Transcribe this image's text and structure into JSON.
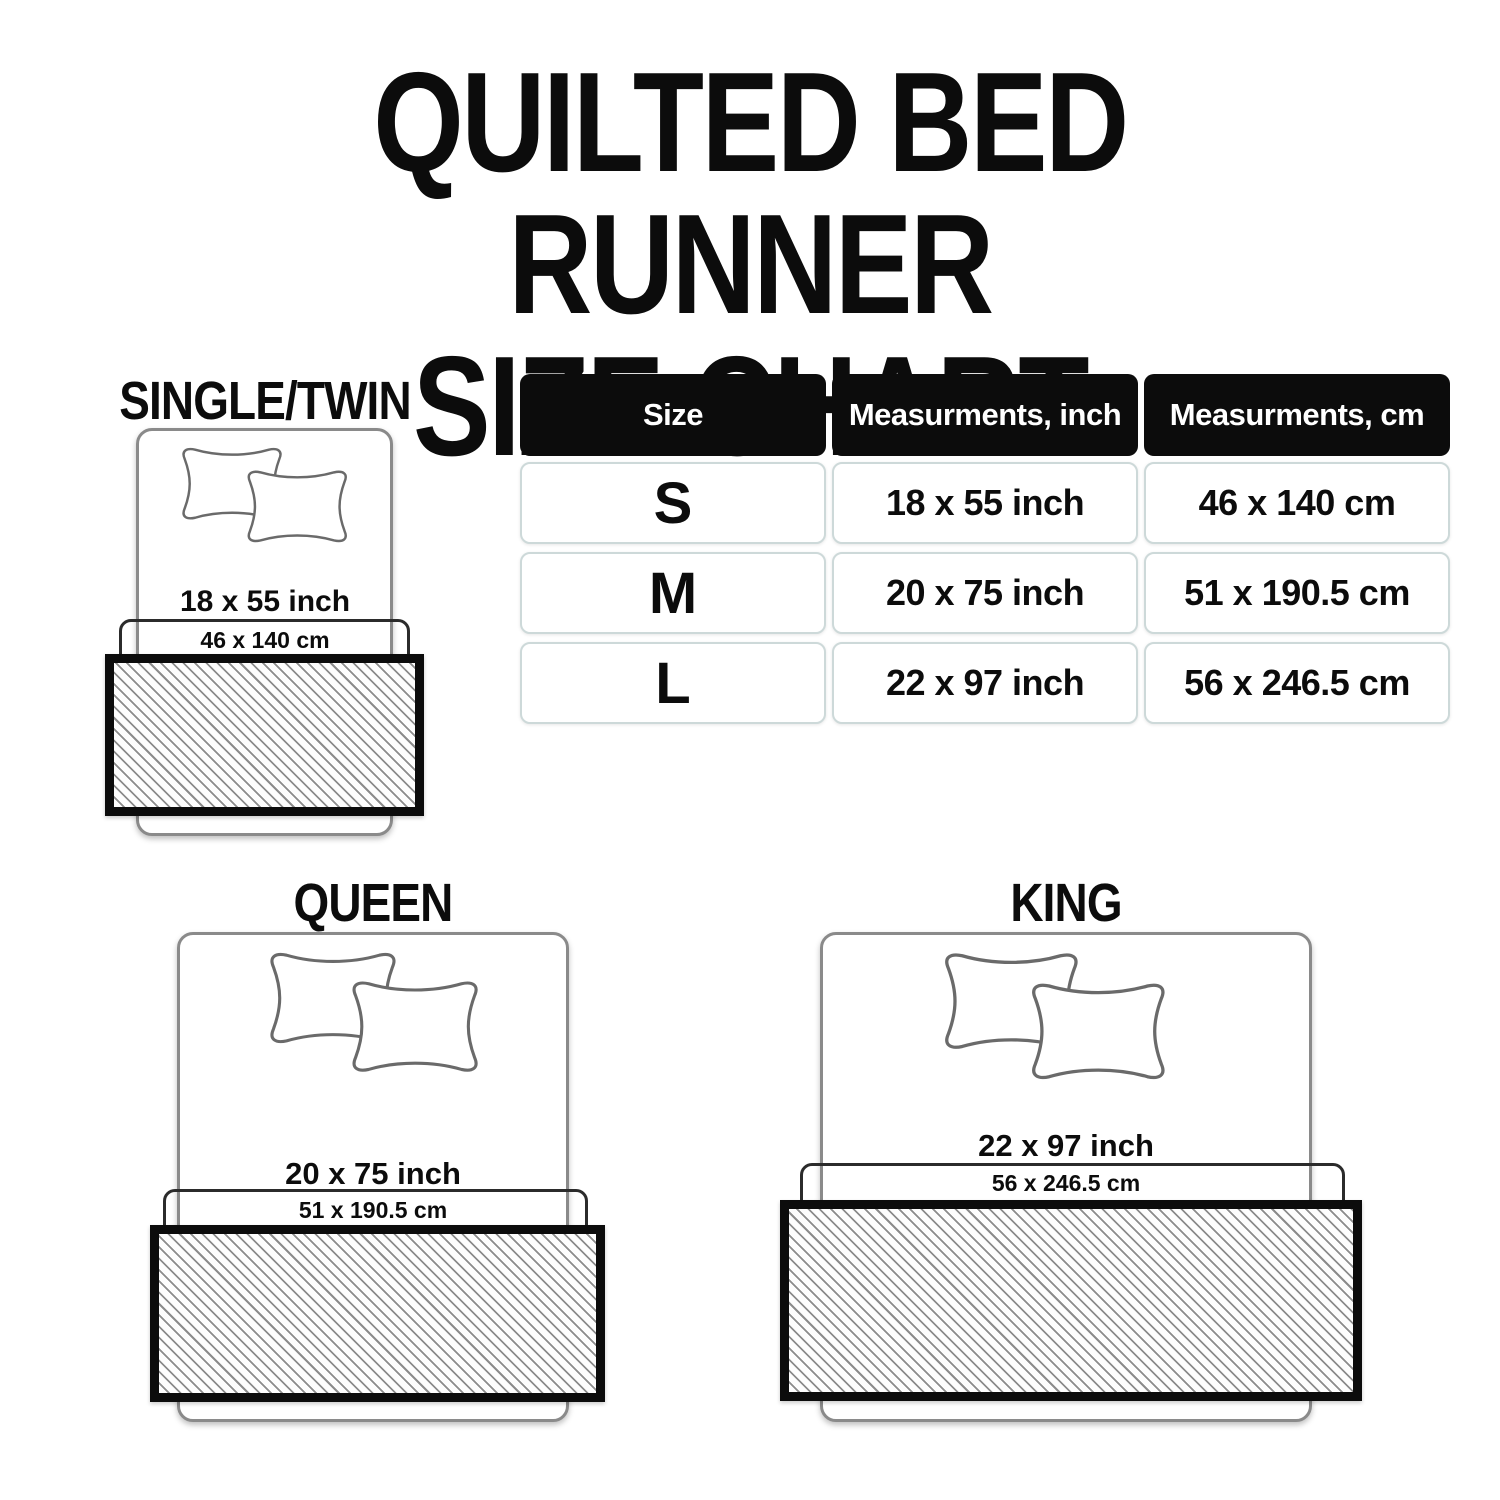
{
  "title": {
    "line1": "QUILTED BED RUNNER",
    "line2": "SIZE CHART"
  },
  "table": {
    "headers": [
      "Size",
      "Measurments, inch",
      "Measurments, cm"
    ],
    "rows": [
      {
        "size": "S",
        "inch": "18 x 55 inch",
        "cm": "46 x 140 cm"
      },
      {
        "size": "M",
        "inch": "20 x 75 inch",
        "cm": "51 x 190.5 cm"
      },
      {
        "size": "L",
        "inch": "22 x 97 inch",
        "cm": "56 x 246.5 cm"
      }
    ]
  },
  "diagrams": {
    "single": {
      "label": "SINGLE/TWIN",
      "inch": "18 x 55 inch",
      "cm": "46 x 140 cm"
    },
    "queen": {
      "label": "QUEEN",
      "inch": "20 x 75 inch",
      "cm": "51 x 190.5 cm"
    },
    "king": {
      "label": "KING",
      "inch": "22 x 97 inch",
      "cm": "56 x 246.5 cm"
    }
  },
  "colors": {
    "ink": "#0c0c0c",
    "header_bg": "#0c0c0c",
    "header_text": "#ffffff",
    "bed_outline": "#8a8a8a",
    "zone_outline": "#2b2b2b",
    "hatch_line": "#8c8c8c",
    "cell_border": "#cdd9d9"
  }
}
